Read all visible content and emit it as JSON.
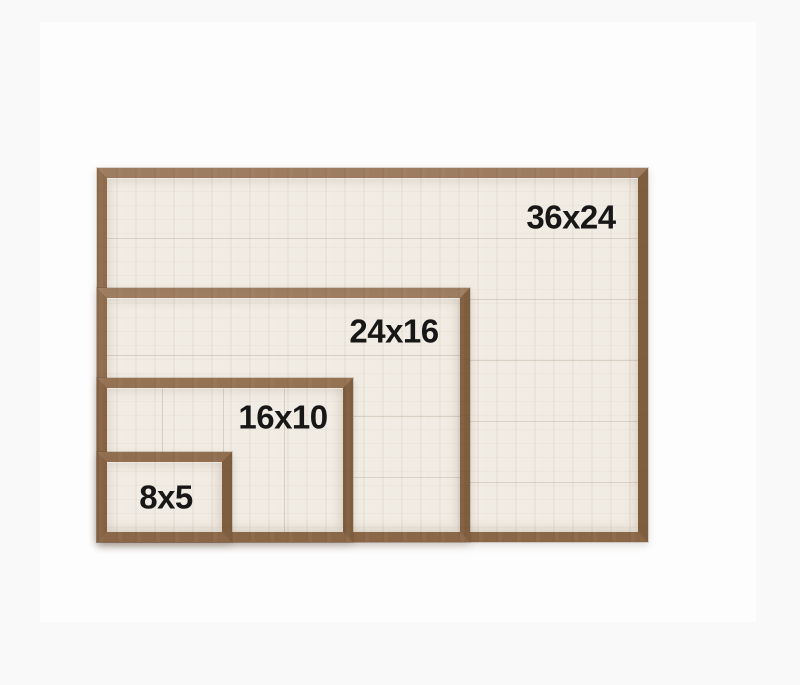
{
  "image": {
    "description": "Size comparison photo of four nested wood-framed shiplap signs sharing a bottom-left corner",
    "page_background": "#f9f9f9",
    "photo_background": "#fdfdfd"
  },
  "colors": {
    "wood_top": "#9d7c60",
    "wood_left": "#8f6c4d",
    "wood_right": "#7f5d3f",
    "wood_bottom": "#8a6747",
    "panel": "#f1ece3",
    "plank_seam": "#d8d1c3",
    "label_text": "#171717"
  },
  "frames": [
    {
      "label": "36x24",
      "width_in": 36,
      "height_in": 24,
      "plank_direction": "horizontal"
    },
    {
      "label": "24x16",
      "width_in": 24,
      "height_in": 16,
      "plank_direction": "horizontal"
    },
    {
      "label": "16x10",
      "width_in": 16,
      "height_in": 10,
      "plank_direction": "vertical"
    },
    {
      "label": "8x5",
      "width_in": 8,
      "height_in": 5,
      "plank_direction": "none"
    }
  ]
}
